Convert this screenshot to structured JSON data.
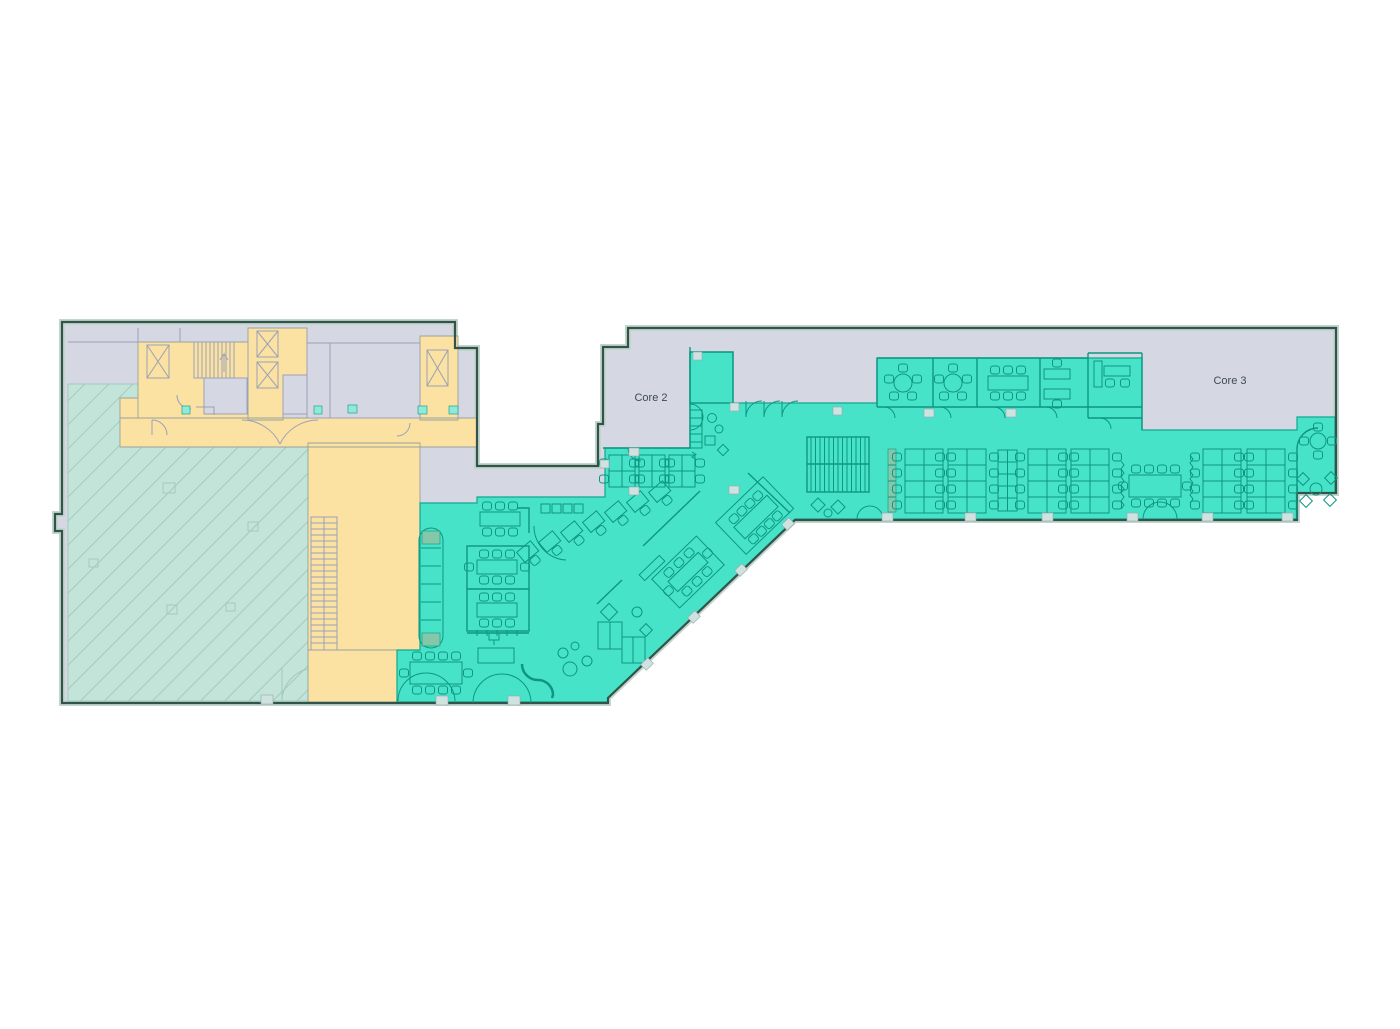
{
  "labels": {
    "core_2": "Core 2",
    "core_3": "Core 3"
  },
  "colors": {
    "canvas": "#ffffff",
    "shell": "#d5d7e3",
    "shell_wall": "#9aa2b6",
    "outline": "#315349",
    "outline_inner": "#c3d6cd",
    "core": "#fbe1a2",
    "core_line": "#9aa39b",
    "hatch": "#c3e4d9",
    "hatch_line": "#a3cabd",
    "office": "#47e3c8",
    "office_line": "#0d9682",
    "office_wall": "#12a78e",
    "planter": "#8fc3a4",
    "column": "#cfe3de",
    "column_teal": "#8feadb",
    "text": "#3e4a54"
  }
}
